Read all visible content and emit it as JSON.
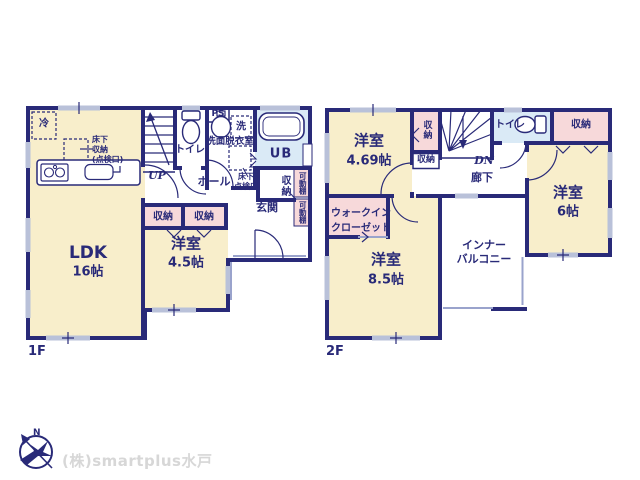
{
  "colors": {
    "wall": "#292a78",
    "room_beige": "#f8eecb",
    "closet_pink": "#f7d9da",
    "bath_blue": "#daeaf6",
    "window_gray": "#b9c1d9",
    "text_navy": "#292a78",
    "logo_gray": "#d7d7d7"
  },
  "floor1": {
    "floor_label": "1F",
    "ldk": {
      "name": "LDK",
      "size": "16帖"
    },
    "bedroom": {
      "name": "洋室",
      "size": "4.5帖"
    },
    "toilet": "トイレ",
    "washroom": "洗面脱衣室",
    "washer": "洗",
    "ps": "PS",
    "bath": "UB",
    "hall": "ホール",
    "entrance": "玄関",
    "closet_a": "収納",
    "closet_b": "収納",
    "closet_side": "収納",
    "shelf_upper": "可動棚",
    "shelf_lower": "可動棚",
    "fridge": "冷",
    "underfloor_storage": "床下\n収納\n(点検口)",
    "underfloor_hatch": "床下\n点検口",
    "stairs": "UP"
  },
  "floor2": {
    "floor_label": "2F",
    "bedroom_469": {
      "name": "洋室",
      "size": "4.69帖"
    },
    "bedroom_85": {
      "name": "洋室",
      "size": "8.5帖"
    },
    "bedroom_6": {
      "name": "洋室",
      "size": "6帖"
    },
    "toilet": "トイレ",
    "hallway": "廊下",
    "stairs": "DN",
    "closet_stairs": "収納",
    "closet_under": "収納",
    "closet_right": "収納",
    "wic": "ウォークイン\nクローゼット",
    "inner_balcony": "インナー\nバルコニー"
  },
  "footer": {
    "company": "(株)smartplus水戸",
    "compass_n": "N"
  }
}
